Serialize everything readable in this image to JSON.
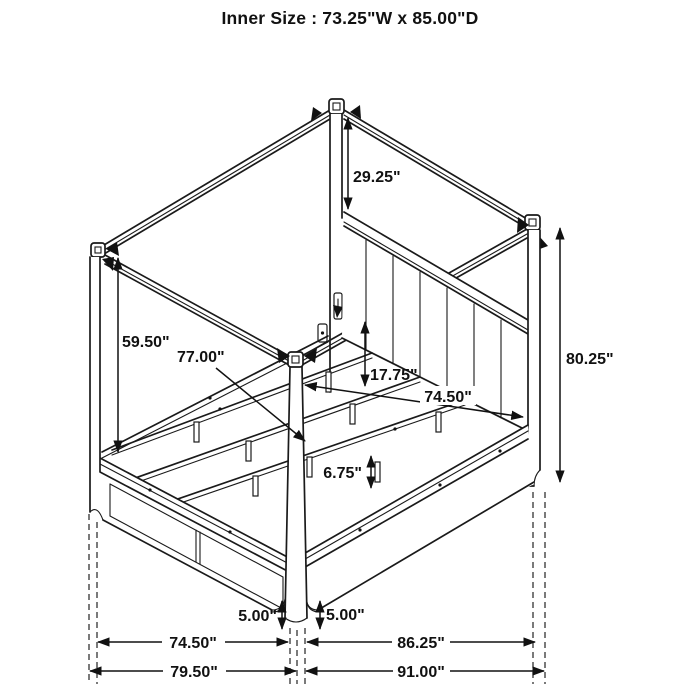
{
  "title": "Inner Size : 73.25\"W x 85.00\"D",
  "colors": {
    "line": "#1a1a1a",
    "background": "#ffffff"
  },
  "dimensions": {
    "canopy_to_headboard_height": "29.25\"",
    "headboard_post_height": "80.25\"",
    "canopy_clearance_height": "59.50\"",
    "slat_rail_length": "77.00\"",
    "rail_to_canopy_gap": "17.75\"",
    "inner_rail_length": "74.50\"",
    "slat_support_height": "6.75\"",
    "left_foot_height": "5.00\"",
    "right_foot_height": "5.00\"",
    "footboard_span": "74.50\"",
    "side_rail_span": "86.25\"",
    "overall_width": "79.50\"",
    "overall_depth": "91.00\""
  }
}
